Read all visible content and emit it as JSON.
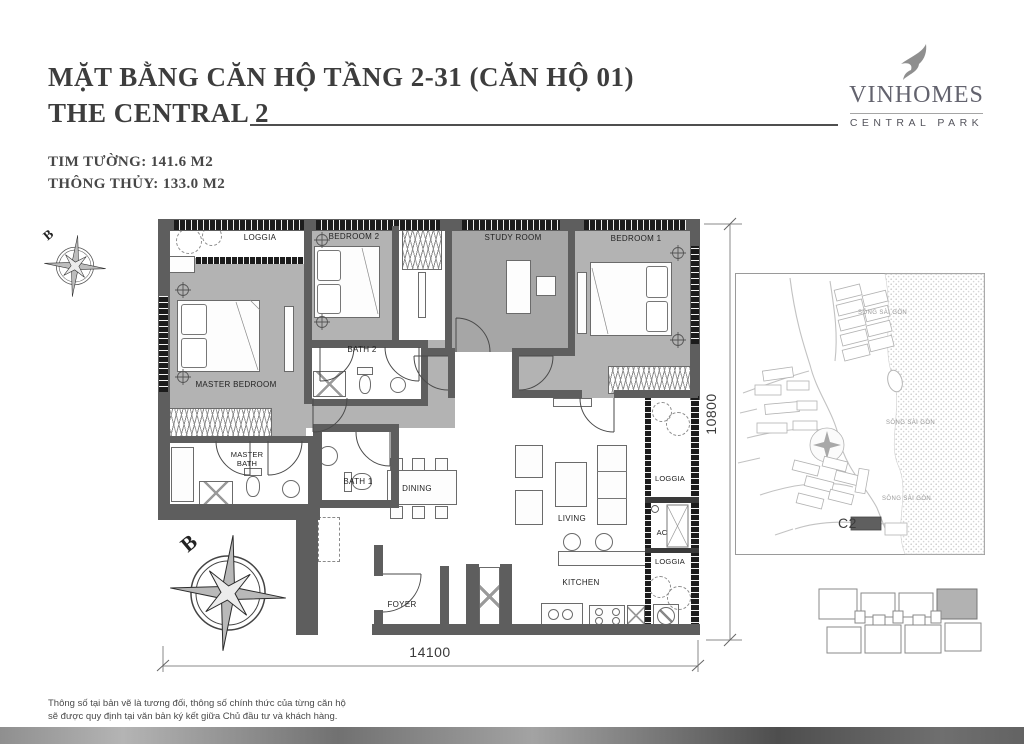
{
  "header": {
    "title": "MẶT BẰNG CĂN HỘ TẦNG 2-31 (CĂN HỘ 01)",
    "subtitle": "THE CENTRAL 2",
    "area_label_1": "TIM TƯỜNG: 141.6 M2",
    "area_label_2": "THÔNG THỦY: 133.0 M2"
  },
  "logo": {
    "brand": "VINHOMES",
    "division": "CENTRAL PARK",
    "icon": "bird-icon"
  },
  "plan": {
    "rooms": {
      "loggia_top": "LOGGIA",
      "bedroom2": "BEDROOM 2",
      "study_room": "STUDY ROOM",
      "bedroom1": "BEDROOM 1",
      "master_bedroom": "MASTER BEDROOM",
      "bath2": "BATH 2",
      "master_bath": "MASTER BATH",
      "bath1": "BATH 1",
      "dining": "DINING",
      "living": "LIVING",
      "kitchen": "KITCHEN",
      "foyer": "FOYER",
      "loggia_right_top": "LOGGIA",
      "ac": "AC",
      "loggia_right_bottom": "LOGGIA"
    },
    "dimensions": {
      "width_mm": "14100",
      "height_mm": "10800"
    },
    "compass_north_label": "B"
  },
  "site_map": {
    "building_label": "C2",
    "river_labels": [
      "SÔNG SÀI GÒN",
      "SÔNG SÀI GÒN",
      "SÔNG SÀI GÒN"
    ]
  },
  "footer": {
    "line1": "Thông số tại bản vẽ là tương đối, thông số chính thức của từng căn hộ",
    "line2": "sẽ được quy định tại văn bản ký kết giữa Chủ đầu tư và khách hàng."
  },
  "colors": {
    "floor_gray": "#b3b3b3",
    "study_gray": "#a6a6a6",
    "wall_gray": "#5e5e5e",
    "window_black": "#1c1c1c",
    "logo_gray": "#63636e",
    "unit_highlight": "#b2b2b2"
  }
}
